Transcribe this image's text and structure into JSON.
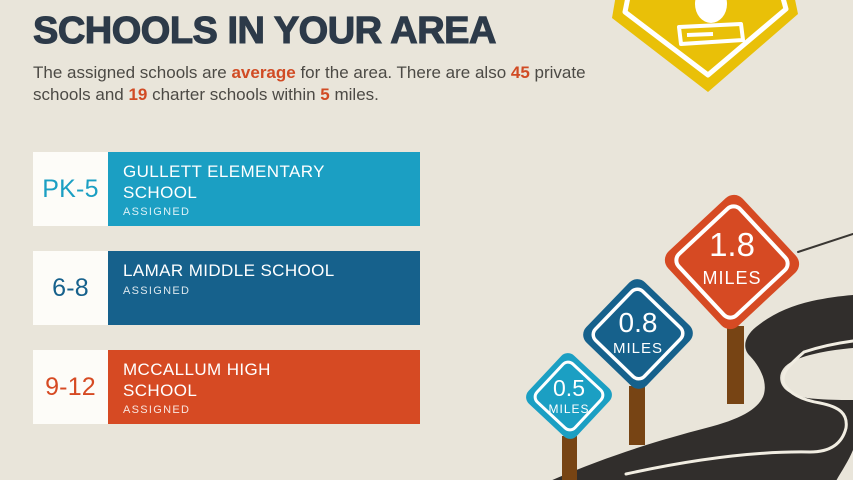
{
  "palette": {
    "background": "#e9e5da",
    "title_color": "#2d3a49",
    "body_text_color": "#4c4a45",
    "accent_orange": "#d14b24",
    "elementary_cyan": "#1b9fc3",
    "middle_blue": "#16618c",
    "high_orange": "#d64a23",
    "school_sign_yellow": "#e9c008",
    "road_charcoal": "#312e2c",
    "post_brown": "#774414"
  },
  "header": {
    "title": "SCHOOLS IN YOUR AREA"
  },
  "intro": {
    "p1": "The assigned schools are ",
    "h1": "average",
    "p2": " for the area. There are also ",
    "h2": "45",
    "p3": " private schools and ",
    "h3": "19",
    "p4": " charter schools within ",
    "h4": "5",
    "p5": " miles."
  },
  "schools": [
    {
      "grades": "PK-5",
      "name": "GULLETT ELEMENTARY SCHOOL",
      "status": "ASSIGNED"
    },
    {
      "grades": "6-8",
      "name": "LAMAR MIDDLE SCHOOL",
      "status": "ASSIGNED"
    },
    {
      "grades": "9-12",
      "name": "MCCALLUM HIGH SCHOOL",
      "status": "ASSIGNED"
    }
  ],
  "road_signs": [
    {
      "distance": "0.5",
      "unit": "MILES"
    },
    {
      "distance": "0.8",
      "unit": "MILES"
    },
    {
      "distance": "1.8",
      "unit": "MILES"
    }
  ]
}
